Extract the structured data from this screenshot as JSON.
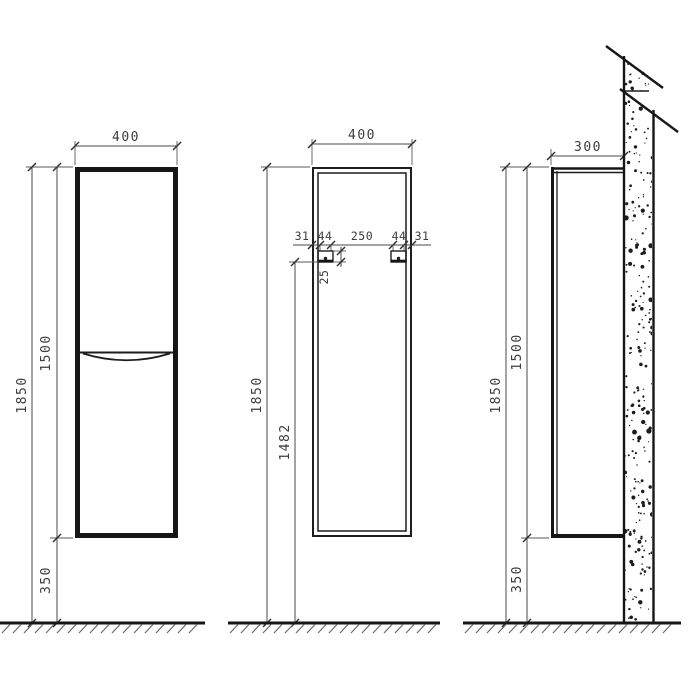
{
  "colors": {
    "line": "#161616",
    "dim_line": "#4a4a4a",
    "text": "#3c3c3c",
    "background": "#ffffff"
  },
  "views": {
    "front": {
      "width": "400",
      "total_height": "1850",
      "body_height": "1500",
      "floor_gap": "350"
    },
    "back": {
      "width": "400",
      "total_height": "1850",
      "mount_height": "1482",
      "edge_offset_left": "31",
      "bracket_width_left": "44",
      "bracket_spacing": "250",
      "bracket_width_right": "44",
      "edge_offset_right": "31",
      "bracket_height": "25"
    },
    "side": {
      "depth": "300",
      "total_height": "1850",
      "body_height": "1500",
      "floor_gap": "350"
    }
  }
}
